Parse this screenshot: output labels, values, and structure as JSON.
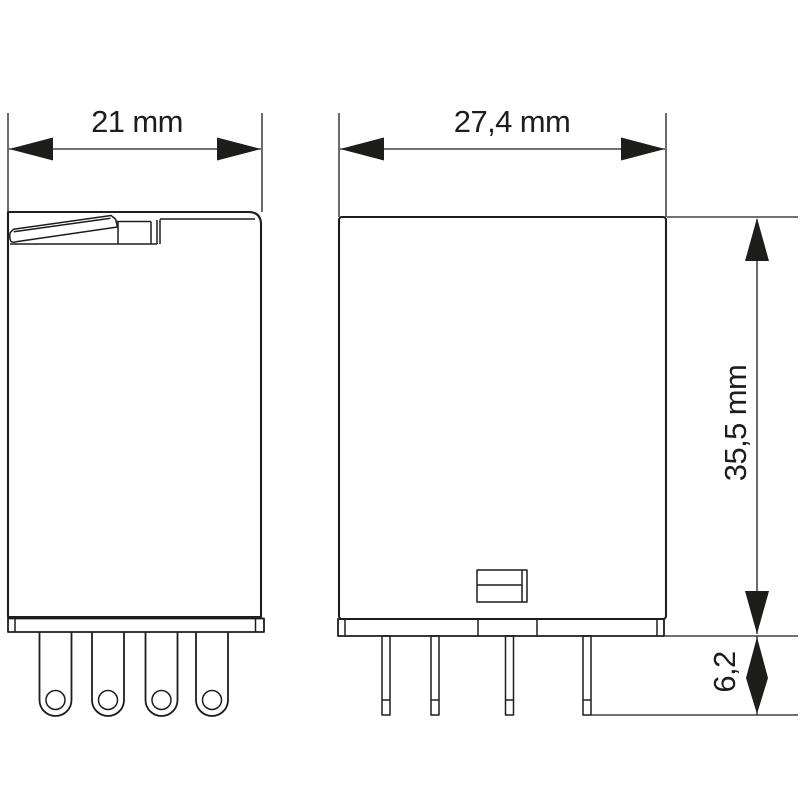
{
  "colors": {
    "ink": "#1d1d1b",
    "background": "#ffffff"
  },
  "dimension_labels": {
    "side_width": "21 mm",
    "front_width": "27,4 mm",
    "height": "35,5 mm",
    "pin_length": "6,2"
  }
}
